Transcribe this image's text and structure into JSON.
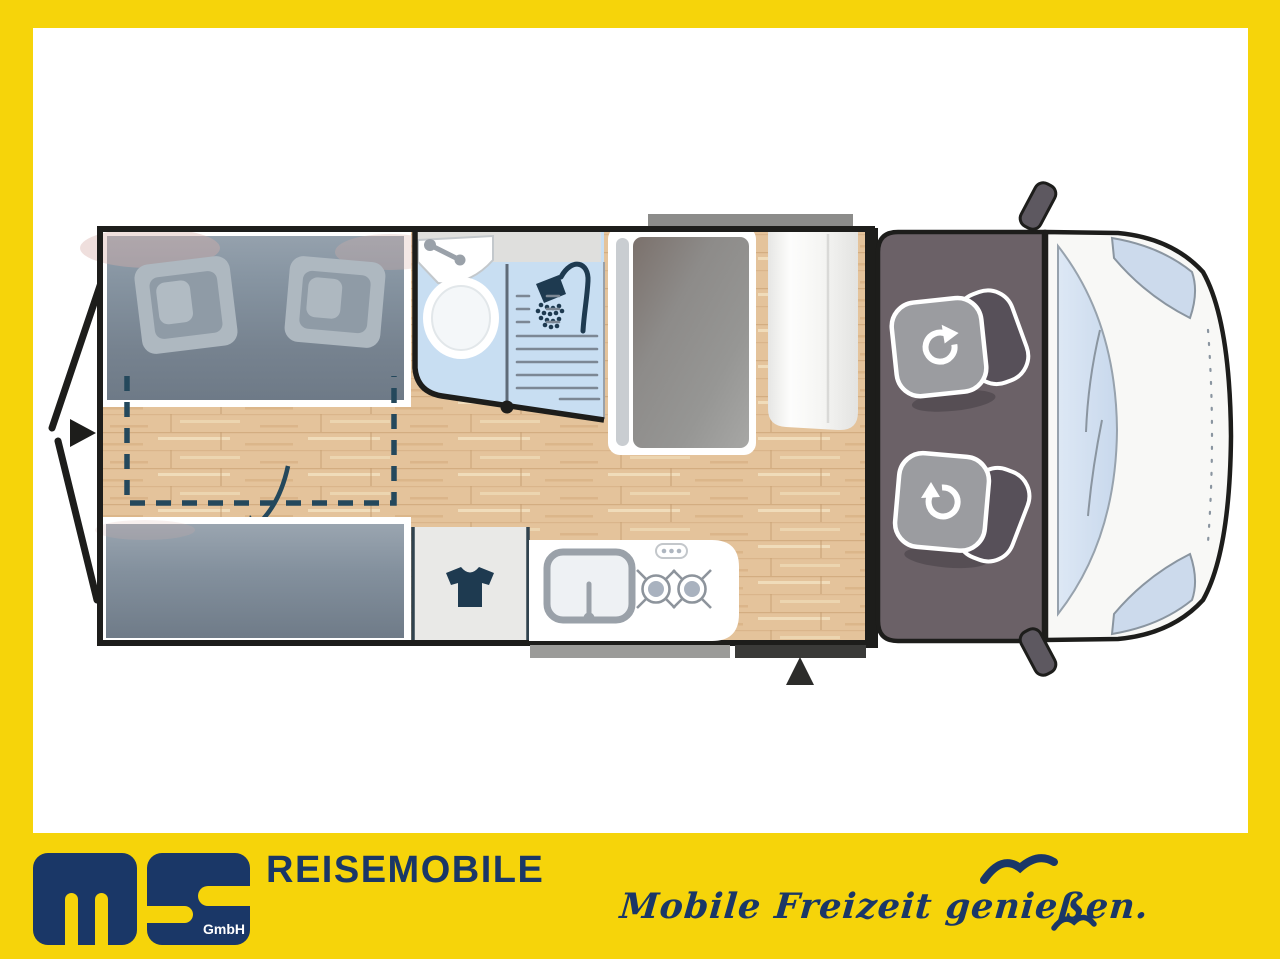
{
  "brand": {
    "gmbh_label": "GmbH",
    "title": "REISEMOBILE",
    "slogan": "Mobile Freizeit genießen."
  },
  "colors": {
    "frame_yellow": "#f6d40a",
    "canvas_white": "#ffffff",
    "brand_navy": "#1a3767",
    "plan_outline": "#1d1d1b",
    "wood_floor": "#e4c39b",
    "mattress_blue_gray": "#7c8894",
    "bathroom_blue": "#c8def2",
    "bathroom_shelf_gray": "#dfdfdd",
    "cab_floor_gray": "#6b6167",
    "seat_cushion_gray": "#9b9ca0",
    "seat_back_gray": "#575059",
    "windshield_blue": "#d9e5f3",
    "accent_slate": "#24485c"
  },
  "floorplan_icons": [
    "rear-door-arrow-icon",
    "pullout-bed-dashed-outline",
    "fold-down-arrow-icon",
    "washbasin-icon",
    "toilet-icon",
    "shower-icon",
    "shower-door-pivot-dot",
    "wardrobe-tshirt-icon",
    "kitchen-sink-icon",
    "stove-burner-icon",
    "stove-control-dots-icon",
    "swivel-seat-icon",
    "entrance-arrow-icon",
    "side-mirror-icon",
    "seagull-icon"
  ]
}
